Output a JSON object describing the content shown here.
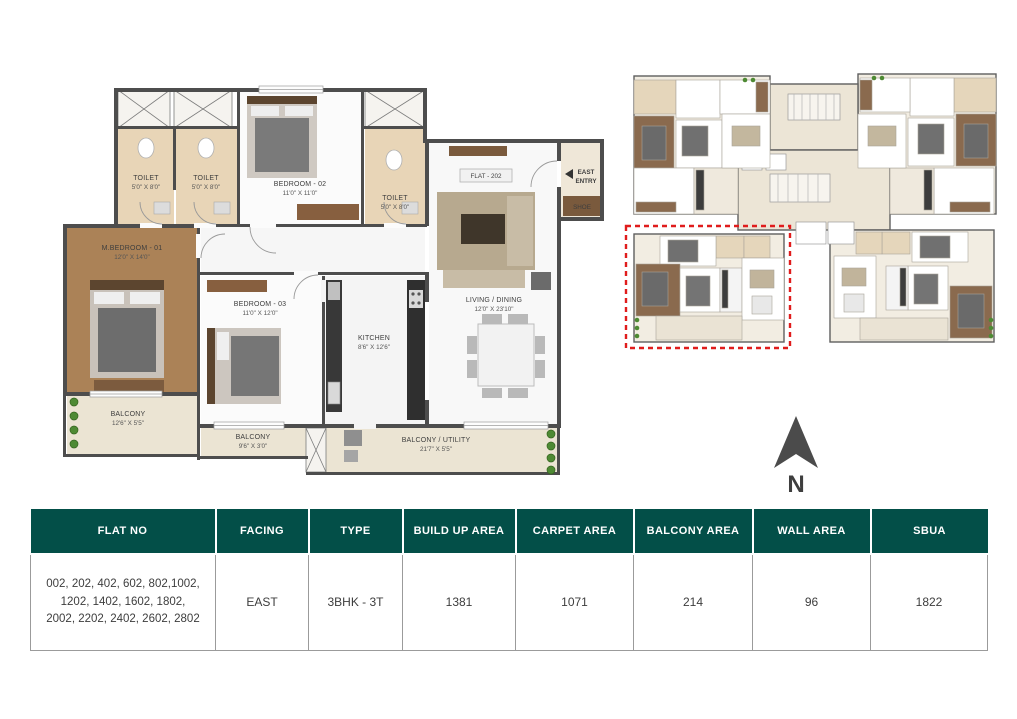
{
  "colors": {
    "table_header_bg": "#034f48",
    "wall": "#4d4d4d",
    "highlight_red": "#e01c1c",
    "toilet_tile": "#e8d5b7",
    "wood": "#8a6a4e",
    "balcony_tile": "#ebe4d3"
  },
  "floor_plan": {
    "flat_label": "FLAT - 202",
    "entry": {
      "line1": "EAST",
      "line2": "ENTRY"
    },
    "shoe_label": "SHOE",
    "rooms": [
      {
        "name": "TOILET",
        "dim": "5'0\" X 8'0\""
      },
      {
        "name": "TOILET",
        "dim": "5'0\" X 8'0\""
      },
      {
        "name": "BEDROOM - 02",
        "dim": "11'0\" X 11'0\""
      },
      {
        "name": "TOILET",
        "dim": "5'0\" X 8'0\""
      },
      {
        "name": "M.BEDROOM - 01",
        "dim": "12'0\" X 14'0\""
      },
      {
        "name": "BEDROOM - 03",
        "dim": "11'0\" X 12'0\""
      },
      {
        "name": "KITCHEN",
        "dim": "8'6\" X 12'6\""
      },
      {
        "name": "LIVING / DINING",
        "dim": "12'0\" X 23'10\""
      },
      {
        "name": "BALCONY",
        "dim": "12'6\" X 5'5\""
      },
      {
        "name": "BALCONY",
        "dim": "9'6\" X 3'0\""
      },
      {
        "name": "BALCONY / UTILITY",
        "dim": "21'7\" X 5'5\""
      }
    ]
  },
  "compass": {
    "label": "N"
  },
  "table": {
    "headers": [
      "FLAT NO",
      "FACING",
      "TYPE",
      "BUILD UP AREA",
      "CARPET AREA",
      "BALCONY AREA",
      "WALL AREA",
      "SBUA"
    ],
    "row": {
      "flat_no": "002, 202, 402, 602, 802,1002, 1202, 1402, 1602, 1802, 2002, 2202, 2402, 2602, 2802",
      "facing": "EAST",
      "type": "3BHK - 3T",
      "build_up_area": "1381",
      "carpet_area": "1071",
      "balcony_area": "214",
      "wall_area": "96",
      "sbua": "1822"
    }
  }
}
